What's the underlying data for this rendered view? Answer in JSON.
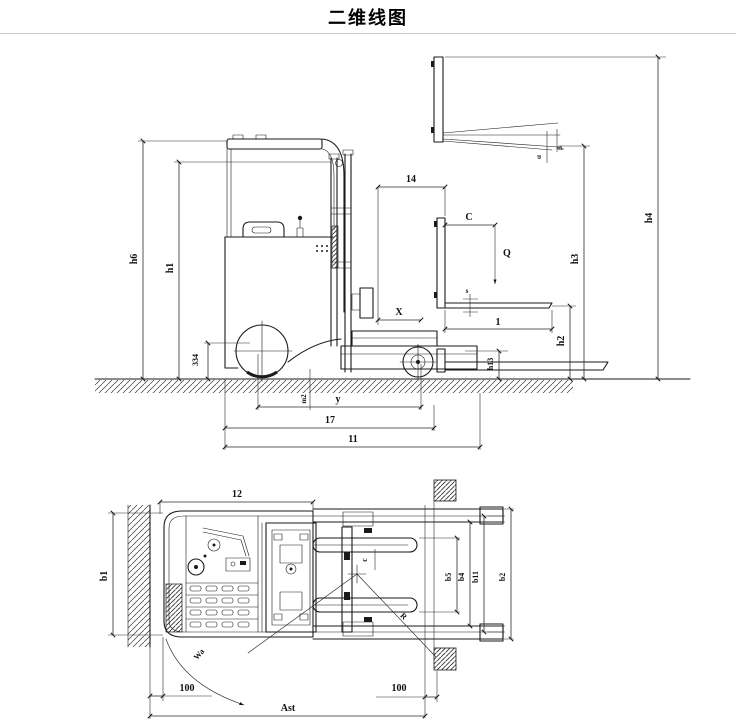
{
  "title": "二维线图",
  "colors": {
    "line": "#1a1a1a",
    "dim_line": "#2a2a2a",
    "separator": "#c8c8c8",
    "background": "#ffffff"
  },
  "side_view": {
    "description": "reach truck side elevation with dimension lines",
    "labels": {
      "h6": "h6",
      "h1": "h1",
      "n334": "334",
      "l4": "14",
      "c": "C",
      "q": "Q",
      "s": "s",
      "l": "1",
      "x": "X",
      "h13": "h13",
      "h2": "h2",
      "h3": "h3",
      "h4": "h4",
      "alpha": "α",
      "beta": "β",
      "m2": "m2",
      "y": "y",
      "l7": "17",
      "l1": "11"
    }
  },
  "top_view": {
    "description": "reach truck plan view in aisle with dimension lines",
    "labels": {
      "l2": "12",
      "b1": "b1",
      "b5": "b5",
      "b4": "b4",
      "b11": "b11",
      "b2": "b2",
      "c": "c",
      "r": "R",
      "wa": "Wa",
      "clearance_left": "100",
      "clearance_right": "100",
      "ast": "Ast"
    }
  }
}
